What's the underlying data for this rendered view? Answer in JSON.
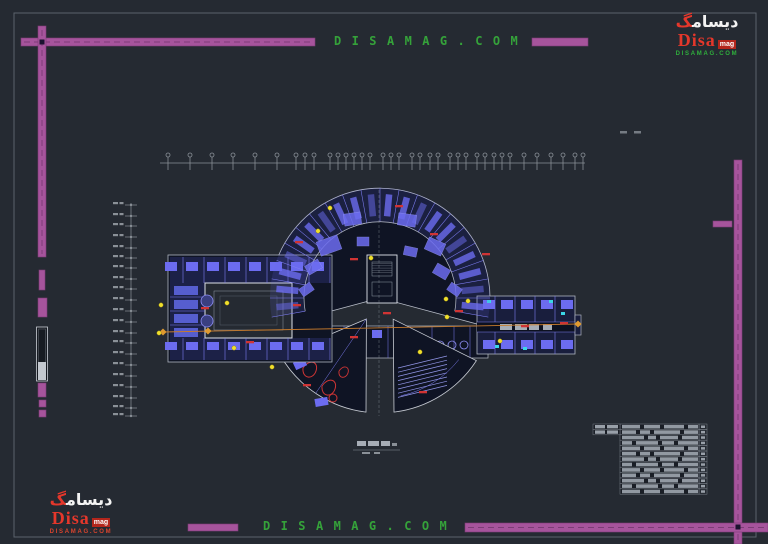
{
  "page": {
    "background": "#252a32"
  },
  "watermarks": {
    "top_center": "D I S A M A G . C O M",
    "bottom_center": "D I S A M A G . C O M"
  },
  "logo": {
    "arabic_word": "دیسام",
    "arabic_accent": "گ",
    "brand": "Disa",
    "brand_suffix": "mag",
    "site": "DISAMAG.COM"
  },
  "colors": {
    "watermark_green": "#35a23a",
    "watermark_magenta": "#a6549c",
    "logo_red": "#e5372b",
    "plan_blue": "#6c6cf0",
    "accent_orange": "#c87b2c",
    "accent_yellow": "#f0e02c",
    "accent_red": "#d03434",
    "accent_cyan": "#3bd6e6"
  },
  "legend_table": {
    "rows": 13,
    "header_rows": 2
  }
}
